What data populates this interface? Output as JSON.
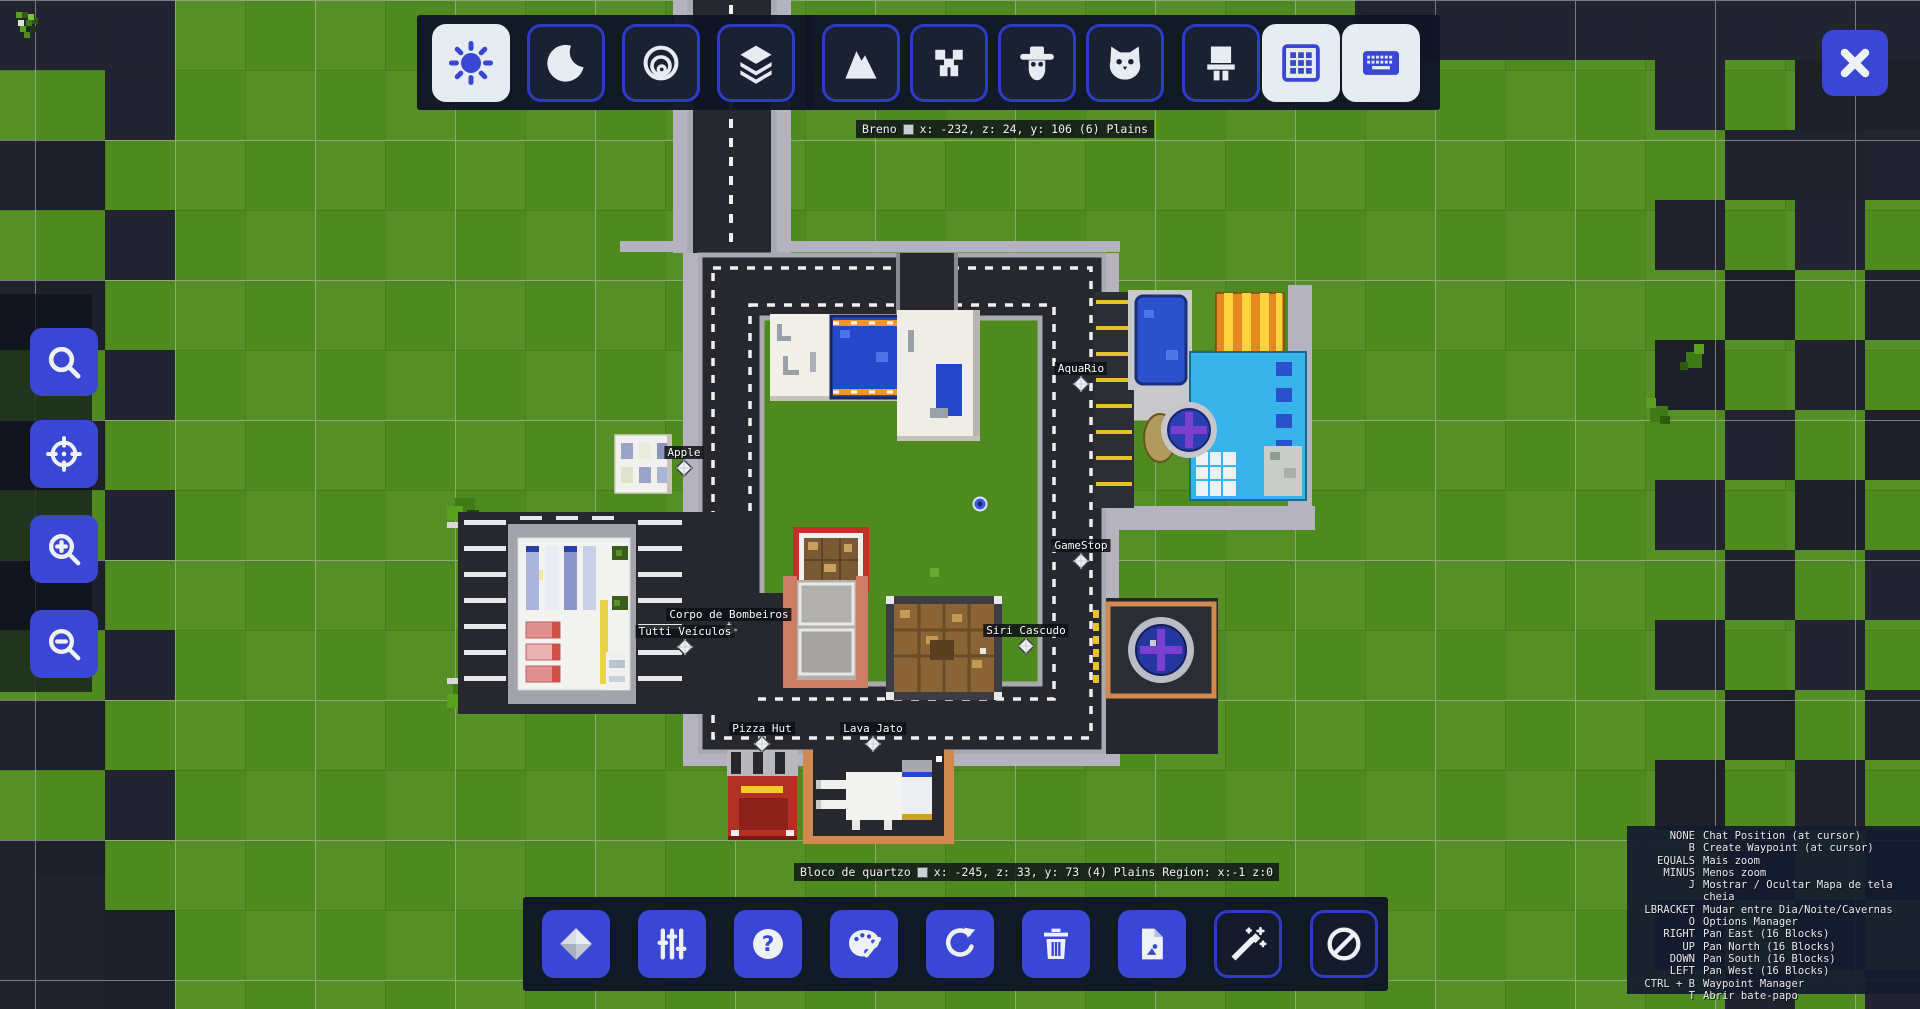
{
  "top_toolbar": {
    "buttons": [
      {
        "id": "day",
        "icon": "sun-icon",
        "active": true
      },
      {
        "id": "night",
        "icon": "moon-icon",
        "active": false
      },
      {
        "id": "caves",
        "icon": "caves-icon",
        "active": false
      },
      {
        "id": "layers",
        "icon": "layers-icon",
        "active": false
      },
      {
        "id": "mountains",
        "icon": "mountain-icon",
        "active": false
      },
      {
        "id": "creepers",
        "icon": "creeper-icon",
        "active": false
      },
      {
        "id": "villagers",
        "icon": "villager-icon",
        "active": false
      },
      {
        "id": "cats",
        "icon": "cat-icon",
        "active": false
      },
      {
        "id": "structures",
        "icon": "structure-icon",
        "active": false
      },
      {
        "id": "grid",
        "icon": "grid-icon",
        "active": true
      },
      {
        "id": "keyboard",
        "icon": "keyboard-icon",
        "active": true
      }
    ]
  },
  "close_button": {
    "icon": "close-icon"
  },
  "left_toolbar": {
    "buttons": [
      {
        "id": "search",
        "icon": "search-icon"
      },
      {
        "id": "center-player",
        "icon": "crosshair-icon"
      },
      {
        "id": "zoom-in",
        "icon": "zoom-in-icon"
      },
      {
        "id": "zoom-out",
        "icon": "zoom-out-icon"
      }
    ]
  },
  "bottom_toolbar": {
    "buttons": [
      {
        "id": "waypoints",
        "icon": "diamond-icon",
        "outline": false
      },
      {
        "id": "settings",
        "icon": "sliders-icon",
        "outline": false
      },
      {
        "id": "help",
        "icon": "help-icon",
        "outline": false
      },
      {
        "id": "theme",
        "icon": "palette-icon",
        "outline": false
      },
      {
        "id": "refresh",
        "icon": "refresh-icon",
        "outline": false
      },
      {
        "id": "delete",
        "icon": "trash-icon",
        "outline": false
      },
      {
        "id": "export",
        "icon": "file-icon",
        "outline": false
      },
      {
        "id": "magic",
        "icon": "wand-icon",
        "outline": true
      },
      {
        "id": "disable",
        "icon": "cancel-icon",
        "outline": true
      }
    ]
  },
  "status_top": {
    "name": "Breno",
    "info": "x: -232, z: 24, y: 106 (6) Plains"
  },
  "status_bottom": {
    "name": "Bloco de quartzo",
    "info": "x: -245, z: 33, y: 73 (4) Plains Region: x:-1 z:0"
  },
  "waypoints": [
    {
      "slug": "aquario",
      "label": "AquaRio",
      "x": 1081,
      "y": 384
    },
    {
      "slug": "apple",
      "label": "Apple",
      "x": 684,
      "y": 468
    },
    {
      "slug": "gamestop",
      "label": "GameStop",
      "x": 1081,
      "y": 561
    },
    {
      "slug": "corpo-de-bombeiros",
      "label": "Corpo de Bombeiros",
      "x": 729,
      "y": 630
    },
    {
      "slug": "tutti-veiculos",
      "label": "Tutti Veículos",
      "x": 685,
      "y": 647
    },
    {
      "slug": "siri-cascudo",
      "label": "Siri Cascudo",
      "x": 1026,
      "y": 646
    },
    {
      "slug": "pizza-hut",
      "label": "Pizza Hut",
      "x": 762,
      "y": 744
    },
    {
      "slug": "lava-jato",
      "label": "Lava Jato",
      "x": 873,
      "y": 744
    }
  ],
  "player_marker": {
    "x": 980,
    "y": 504
  },
  "keybinds": [
    {
      "key": "NONE",
      "action": "Chat Position (at cursor)"
    },
    {
      "key": "B",
      "action": "Create Waypoint (at cursor)"
    },
    {
      "key": "EQUALS",
      "action": "Mais zoom"
    },
    {
      "key": "MINUS",
      "action": "Menos zoom"
    },
    {
      "key": "J",
      "action": "Mostrar / Ocultar Mapa de tela cheia"
    },
    {
      "key": "LBRACKET",
      "action": "Mudar entre Dia/Noite/Cavernas"
    },
    {
      "key": "O",
      "action": "Options Manager"
    },
    {
      "key": "RIGHT",
      "action": "Pan East (16 Blocks)"
    },
    {
      "key": "UP",
      "action": "Pan North (16 Blocks)"
    },
    {
      "key": "DOWN",
      "action": "Pan South (16 Blocks)"
    },
    {
      "key": "LEFT",
      "action": "Pan West (16 Blocks)"
    },
    {
      "key": "CTRL + B",
      "action": "Waypoint Manager"
    },
    {
      "key": "T",
      "action": "Abrir bate-papo"
    }
  ],
  "colors": {
    "accent": "#3a46d4",
    "button_active_bg": "#e7ecf3",
    "panel": "#141927",
    "grass": "#4e8a1d",
    "dark_chunk": "#20222e",
    "asphalt": "#26282e",
    "label_bg": "#15181f"
  }
}
